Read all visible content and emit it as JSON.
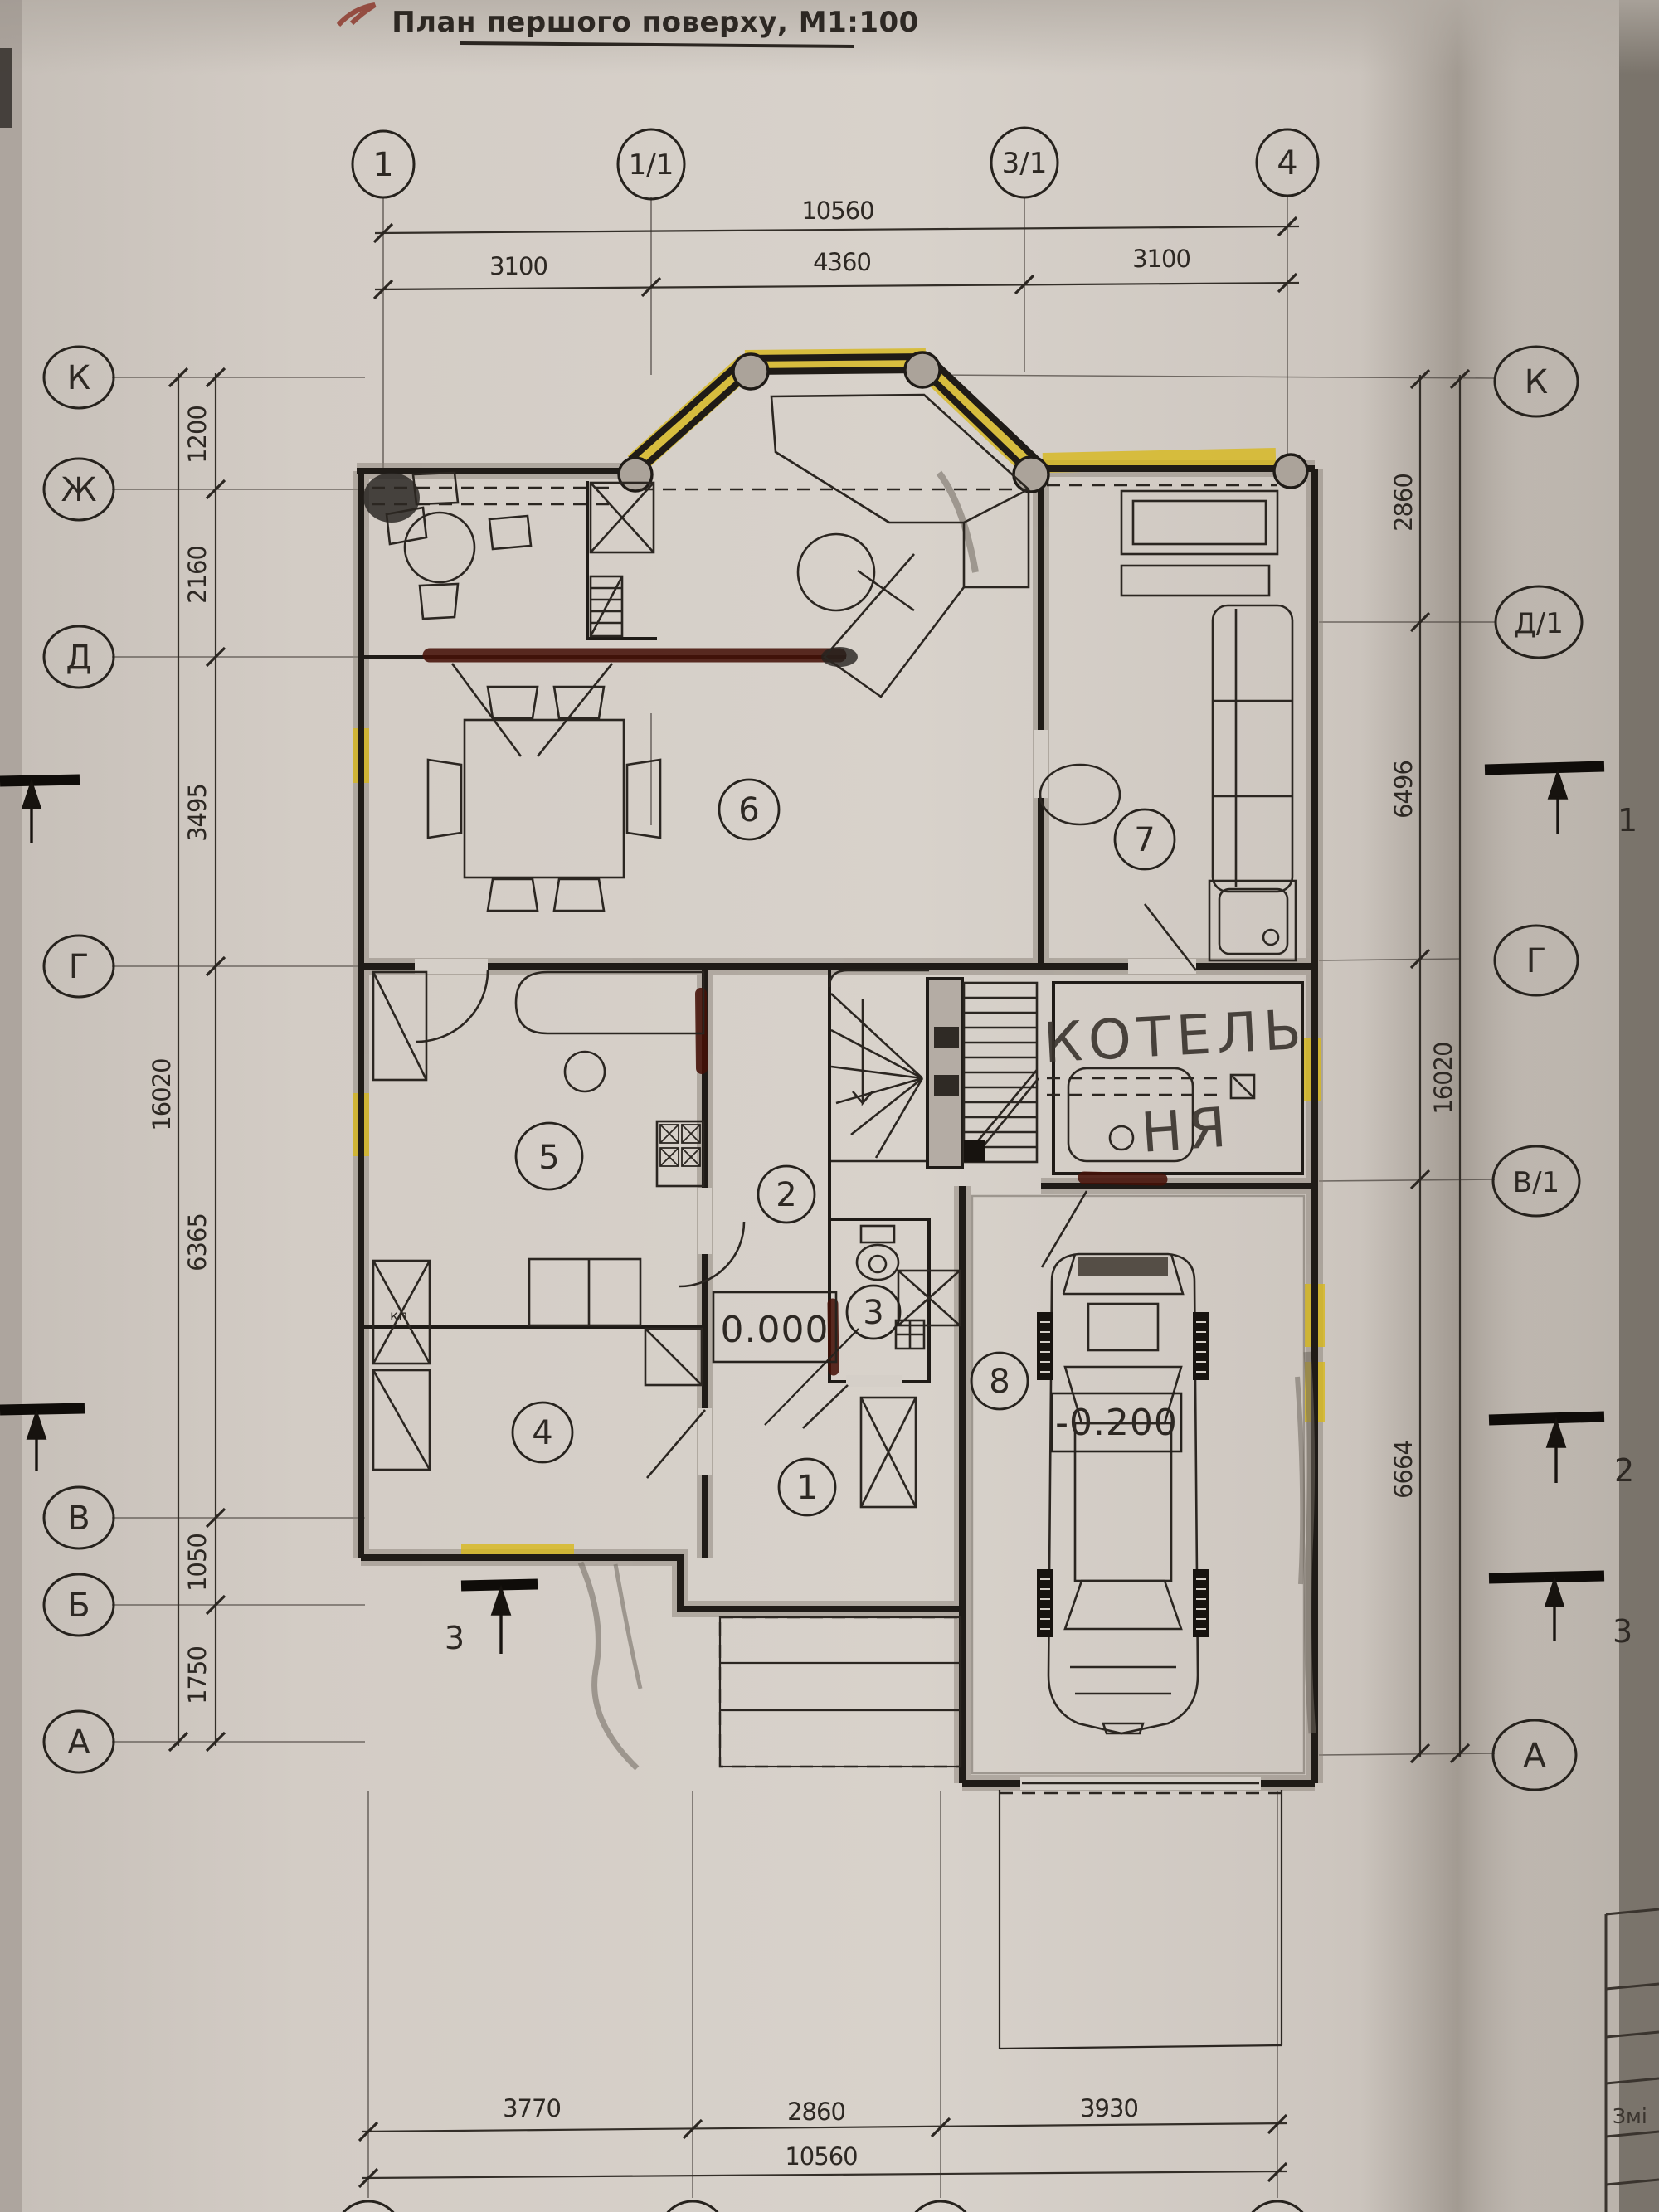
{
  "title": "План першого поверху, М1:100",
  "axes": {
    "top": [
      "1",
      "1/1",
      "3/1",
      "4"
    ],
    "left": [
      "К",
      "Ж",
      "Д",
      "Г",
      "В",
      "Б",
      "А"
    ],
    "right": [
      "К",
      "Д/1",
      "Г",
      "В/1",
      "А"
    ]
  },
  "dims": {
    "top_total": "10560",
    "top_segs": [
      "3100",
      "4360",
      "3100"
    ],
    "left_total": "16020",
    "left_segs": [
      "1200",
      "2160",
      "3495",
      "6365",
      "1050",
      "1750"
    ],
    "right_total": "16020",
    "right_segs": [
      "2860",
      "6496",
      "6664"
    ],
    "bottom_total": "10560",
    "bottom_segs": [
      "3770",
      "2860",
      "3930"
    ]
  },
  "rooms": [
    "1",
    "2",
    "3",
    "4",
    "5",
    "6",
    "7",
    "8"
  ],
  "sections": {
    "right": [
      "1",
      "2",
      "3"
    ],
    "left_inplan": "3"
  },
  "annotations": {
    "boiler_line1": "КОТЕЛЬ",
    "boiler_line2": "НЯ",
    "elev_main": "0.000",
    "elev_garage": "-0.200",
    "kitchen_note": "кп",
    "titleblock_row": "Змі"
  },
  "colors": {
    "highlight": "#d7b81c",
    "marker": "#451108",
    "paper": "#cfc8c1"
  }
}
